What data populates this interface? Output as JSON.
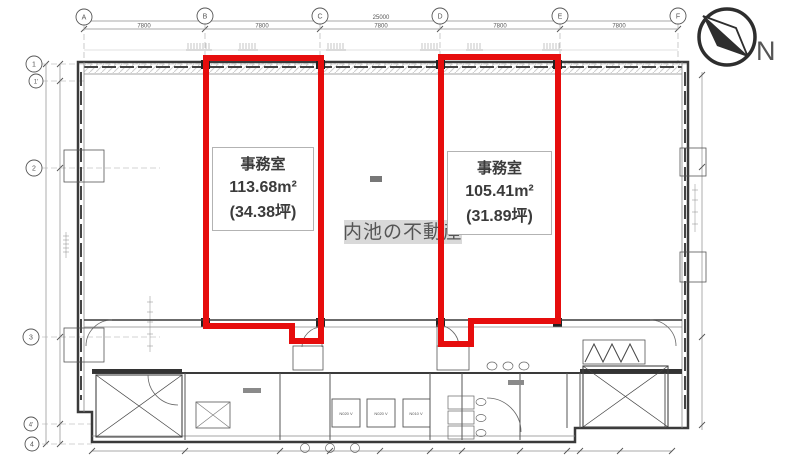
{
  "compass": {
    "label": "N"
  },
  "watermark": {
    "text": "内池の不動産"
  },
  "units": [
    {
      "room_type": "事務室",
      "area_sqm": "113.68m²",
      "area_tsubo": "(34.38坪)"
    },
    {
      "room_type": "事務室",
      "area_sqm": "105.41m²",
      "area_tsubo": "(31.89坪)"
    }
  ],
  "grid": {
    "columns": [
      "A",
      "B",
      "C",
      "D",
      "E",
      "F"
    ],
    "rows": [
      "1",
      "1'",
      "2",
      "3",
      "4'",
      "4"
    ]
  },
  "dimensions": {
    "overall_width": "25000",
    "bay_widths": [
      "7800",
      "7800",
      "7800",
      "7800",
      "7800"
    ]
  },
  "equipment_pads": [
    "N020 V",
    "N020 V",
    "N010 V"
  ],
  "colors": {
    "highlight_red": "#e60d0d",
    "wall_line": "#3a3a3a"
  }
}
